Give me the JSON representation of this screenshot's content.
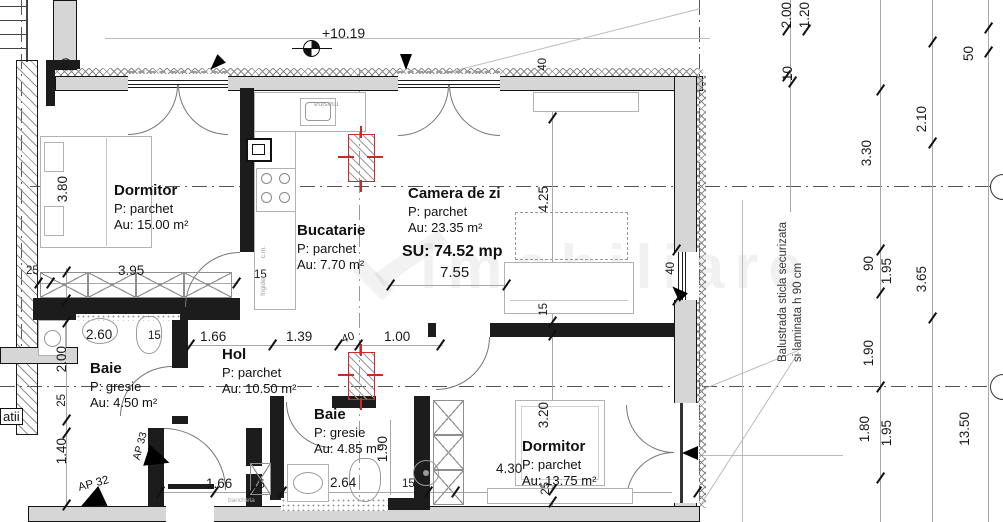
{
  "level": "+10.19",
  "rooms": [
    {
      "name": "Dormitor",
      "floor": "P: parchet",
      "area": "Au: 15.00 m²"
    },
    {
      "name": "Bucatarie",
      "floor": "P: parchet",
      "area": "Au: 7.70 m²"
    },
    {
      "name": "Camera de zi",
      "floor": "P: parchet",
      "area": "Au: 23.35 m²"
    },
    {
      "name": "Baie",
      "floor": "P: gresie",
      "area": "Au: 4.50 m²"
    },
    {
      "name": "Hol",
      "floor": "P: parchet",
      "area": "Au: 10.50 m²"
    },
    {
      "name": "Baie",
      "floor": "P: gresie",
      "area": "Au: 4.85 m²"
    },
    {
      "name": "Dormitor",
      "floor": "P: parchet",
      "area": "Au: 13.75 m²"
    }
  ],
  "summary": {
    "total": "SU: 74.52 mp",
    "width": "7.55"
  },
  "apartments": {
    "ap33": "AP 33",
    "ap32": "AP 32"
  },
  "notes": {
    "balustrade_line1": "Balustrada sticla securizata",
    "balustrade_line2": "si laminata h 90 cm",
    "left_partial": "atii",
    "bench": "bancheta",
    "fridge": "frigider",
    "cm": "c.m.",
    "washer": "masina",
    "watermark": "imobiliare"
  },
  "dims": {
    "wall40_a": "40",
    "wall40_b": "40",
    "wall40_right": "40",
    "dorm1_h": "3.80",
    "dorm1_off": "25",
    "dorm1_w": "3.95",
    "baie1_t15": "15",
    "baie1_w": "2.60",
    "baie1_r15": "15",
    "baie1_h": "2.00",
    "baie1_b25": "25",
    "left_140": "1.40",
    "hol_166": "1.66",
    "hol_139": "1.39",
    "hol_40": "40",
    "hol_100": "1.00",
    "kitchen_15": "15",
    "living_425": "4.25",
    "living_15": "15",
    "dorm2_320": "3.20",
    "dorm2_430": "4.30",
    "dorm2_25": "25",
    "baie2_190": "1.90",
    "baie2_264": "2.64",
    "baie2_15": "15",
    "bottom_166": "1.66",
    "bottom_15": "15",
    "r_200": "2.00",
    "r_120": "1.20",
    "r_10": "10",
    "r_50": "50",
    "r_210": "2.10",
    "r_330": "3.30",
    "r_90": "90",
    "r_195a": "1.95",
    "r_365": "3.65",
    "r_190": "1.90",
    "r_180": "1.80",
    "r_195b": "1.95",
    "r_1350": "13.50"
  },
  "colors": {
    "column_red": "#cc2a27",
    "wall_gray": "#d6d6d6"
  }
}
